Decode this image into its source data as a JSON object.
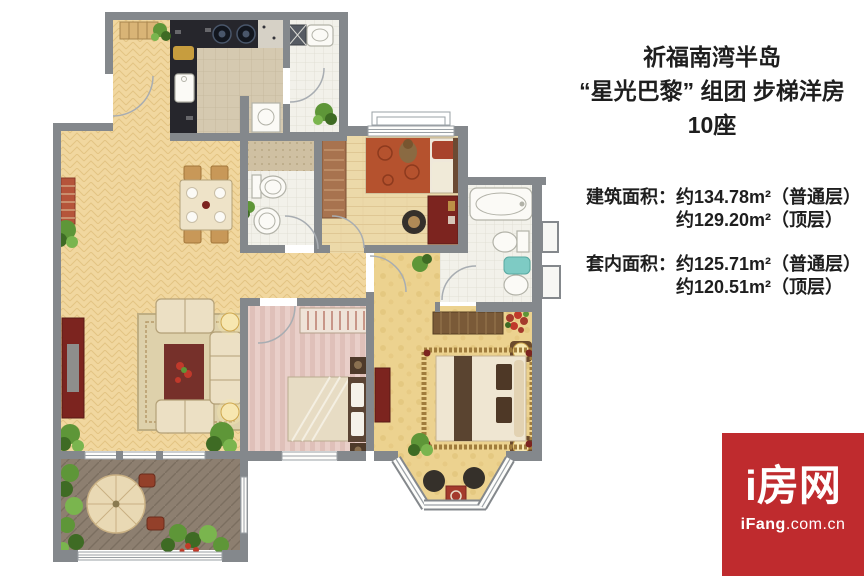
{
  "title": {
    "line1": "祈福南湾半岛",
    "line2": "“星光巴黎” 组团 步梯洋房",
    "line3": "10座"
  },
  "areas": {
    "building_label": "建筑面积：",
    "building_normal": "约134.78m²（普通层）",
    "building_top": "约129.20m²（顶层）",
    "inner_label": "套内面积：",
    "inner_normal": "约125.71m²（普通层）",
    "inner_top": "约120.51m²（顶层）"
  },
  "logo": {
    "brand": "i房网",
    "site_bold": "iFang",
    "site_rest": ".com.cn"
  },
  "floor_plan": {
    "colors": {
      "wall": "#84888c",
      "wood": "#f1d79f",
      "wood_line": "#e3c483",
      "plank": "#ecd9a9",
      "plank_line": "#dfc794",
      "tile": "#f2f1ea",
      "tile_line": "#dddcd0",
      "ktile": "#d5c9b0",
      "ktile_line": "#c3b69a",
      "pink_a": "#e9cfc9",
      "pink_b": "#dfc0b9",
      "gold": "#ecd28f",
      "gold_dot": "#e0c176",
      "deck": "#8d7f70",
      "deck_line": "#7b6e60",
      "mosaic": "#cfc0a2",
      "mosaic_dot": "#b9a884",
      "counter": "#26262c",
      "cream": "#ece0c4",
      "cream_line": "#b3a077",
      "red_dark": "#7c241f",
      "red_mid": "#a43a2c",
      "white_fix": "#fbfaf6",
      "fix_line": "#b2b2a8",
      "teal": "#7ecbc4",
      "green_dark": "#3e6b24",
      "green_mid": "#5e9638",
      "green_light": "#7ab54e",
      "glow": "#f7e7b0",
      "glow_edge": "#cfa84e",
      "brown": "#7a5a38",
      "brown_dark": "#5a4430",
      "tan": "#d9b476",
      "logo_bg": "#bf2b2e"
    }
  }
}
